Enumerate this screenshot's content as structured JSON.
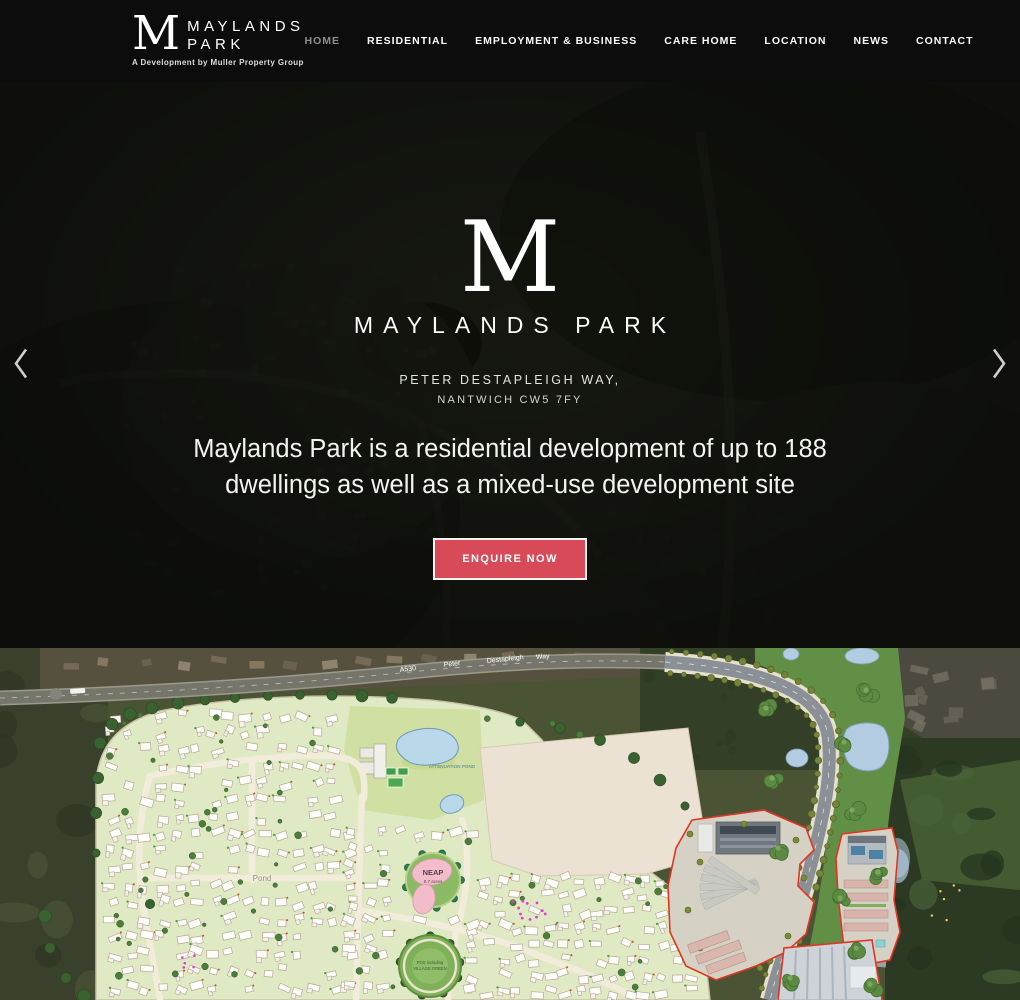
{
  "header": {
    "logo": {
      "monogram": "M",
      "title_line1": "MAYLANDS",
      "title_line2": "PARK",
      "tagline": "A Development by Muller Property Group"
    },
    "nav": [
      {
        "label": "HOME",
        "active": true
      },
      {
        "label": "RESIDENTIAL",
        "active": false
      },
      {
        "label": "EMPLOYMENT & BUSINESS",
        "active": false
      },
      {
        "label": "CARE HOME",
        "active": false
      },
      {
        "label": "LOCATION",
        "active": false
      },
      {
        "label": "NEWS",
        "active": false
      },
      {
        "label": "CONTACT",
        "active": false
      }
    ]
  },
  "hero": {
    "monogram": "M",
    "brand": "MAYLANDS PARK",
    "address_line1": "PETER DESTAPLEIGH WAY,",
    "address_line2": "NANTWICH CW5 7FY",
    "heading_line1": "Maylands Park is a residential development of up to 188",
    "heading_line2": "dwellings as well as a mixed-use development site",
    "cta_label": "ENQUIRE NOW"
  },
  "masterplan": {
    "road_labels": [
      "A530",
      "Peter",
      "Destapleigh",
      "Way"
    ],
    "labels": {
      "attenuation_pond": "ATTENUATION POND",
      "neap": "NEAP",
      "neap_area": "0.7 acres",
      "pond": "Pond",
      "village_green_line1": "POS including",
      "village_green_line2": "VILLAGE GREEN"
    }
  },
  "colors": {
    "header_bg": "#0c0c0d",
    "cta_bg": "#d84a57",
    "cta_text": "#ffffff",
    "nav_active": "#8f8f8f",
    "boundary_red": "#e03522",
    "plan_green": "#dfe9c4",
    "pond_blue": "#b9d8ea",
    "neap_pink": "#f2bccb"
  }
}
